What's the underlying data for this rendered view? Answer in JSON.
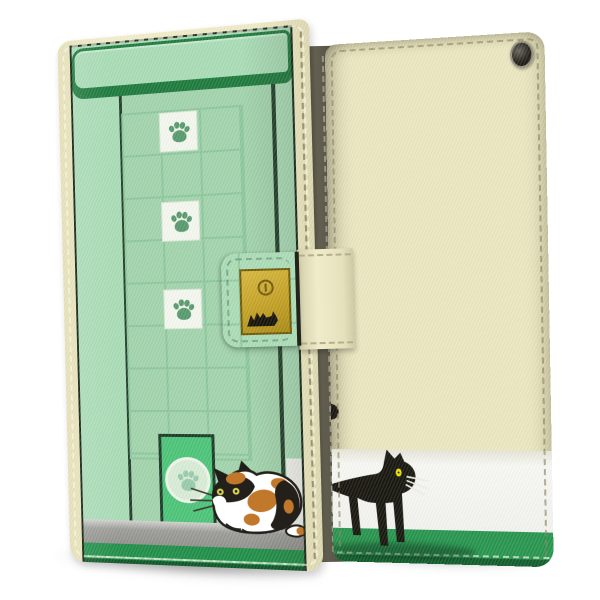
{
  "image": {
    "type": "product-photo",
    "subject": "Flip wallet smartphone case with cat storefront print, front and back views",
    "background_color": "#ffffff",
    "visible_text": "none"
  },
  "front_view": {
    "label": "front-cover-with-strap-closed",
    "case_edge_color": "#efeac6",
    "edge_stitching": "dashed seam",
    "design": {
      "theme": "green storefront with window, pet door and calico cat",
      "awning": {
        "fill": "#a9dcb6",
        "border_color": "#1d7a3c"
      },
      "wall_color": "#a9dcb6",
      "window": {
        "glass_color": "#a2d4ac",
        "frame_color": "#223c2a",
        "grid_line_color": "#8cc79c",
        "columns": 3,
        "rows": 8
      },
      "paw_tiles": {
        "count": 3,
        "tile_color": "#f4f7ee",
        "paw_color": "#579a6d",
        "positions": [
          "column 2 row 1",
          "column 2 row 3",
          "column 2 row 5"
        ]
      },
      "door": {
        "fill": "#4cc478",
        "frame_color": "#1c3a28",
        "emblem": "paw-print-in-circle",
        "circle_color": "#d8ecd4",
        "emblem_paw_color": "#98cbaa"
      },
      "step_color": "#9c9c98",
      "ground_color": "#1f8f48",
      "cat": {
        "kind": "calico-cat-crouching",
        "body_color": "#ffffff",
        "patch_colors": [
          "#23201b",
          "#c2782a"
        ],
        "eye_color": "#ddd64e"
      }
    }
  },
  "strap": {
    "over_front_color": "#abdcb6",
    "over_spine_color": "#f0ebc9",
    "fold_crease_color": "#23231b",
    "clasp": {
      "shape": "square plate",
      "fill": "#c3a124",
      "border_color": "#6e5808",
      "snap_button": "round snap with slit",
      "motif": "black-cat-zigzag-glyph"
    }
  },
  "spine": {
    "color": "#55524 6-dark-olive",
    "stitch": "vertical dashed seam"
  },
  "back_view": {
    "label": "back-cover",
    "body_color": "#ebe7c1",
    "camera_hole": {
      "shape": "round",
      "color": "#23221b",
      "rim_color": "#97927e"
    },
    "bands": {
      "white_band_color": "#f5f5f1",
      "ground_color": "#27954e"
    },
    "cat": {
      "kind": "black-cat-walking-right",
      "color": "#17150e",
      "eye_color": "#e8e100",
      "whisker_color": "#eeeee4",
      "tail_tip_visible_on_left_edge": true
    },
    "edge_stitching": "dashed seam"
  },
  "shadows": {
    "color": "rgba(0,0,0,0.28)"
  }
}
